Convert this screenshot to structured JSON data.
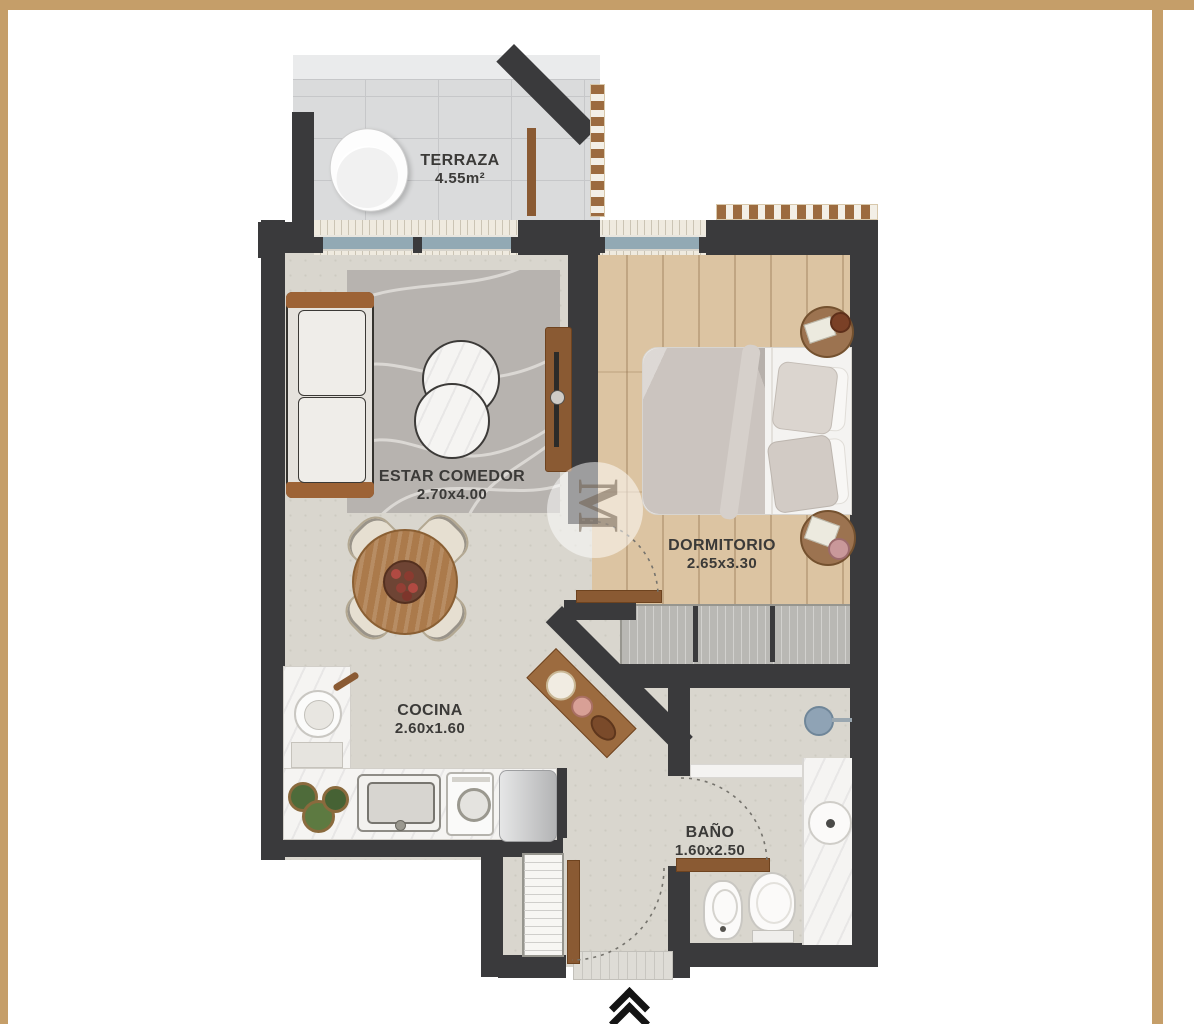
{
  "plan": {
    "watermark_letter": "M",
    "entrance_marker": "double-chevron-up",
    "rooms": [
      {
        "id": "terraza",
        "name": "TERRAZA",
        "size": "4.55m²"
      },
      {
        "id": "estar-comedor",
        "name": "ESTAR COMEDOR",
        "size": "2.70x4.00"
      },
      {
        "id": "dormitorio",
        "name": "DORMITORIO",
        "size": "2.65x3.30"
      },
      {
        "id": "cocina",
        "name": "COCINA",
        "size": "2.60x1.60"
      },
      {
        "id": "bano",
        "name": "BAÑO",
        "size": "1.60x2.50"
      }
    ],
    "colors": {
      "frame_border": "#C59E69",
      "wall": "#3A3A3C",
      "interior_floor": "#D9D6CE",
      "wood_floor": "#DCC4A2",
      "terrace_tile": "#DADBDC",
      "rug": "#B7B3AF",
      "window_glass": "#92A9B4",
      "wood_furniture": "#8A5A33",
      "label_text": "#3B3A38"
    }
  }
}
